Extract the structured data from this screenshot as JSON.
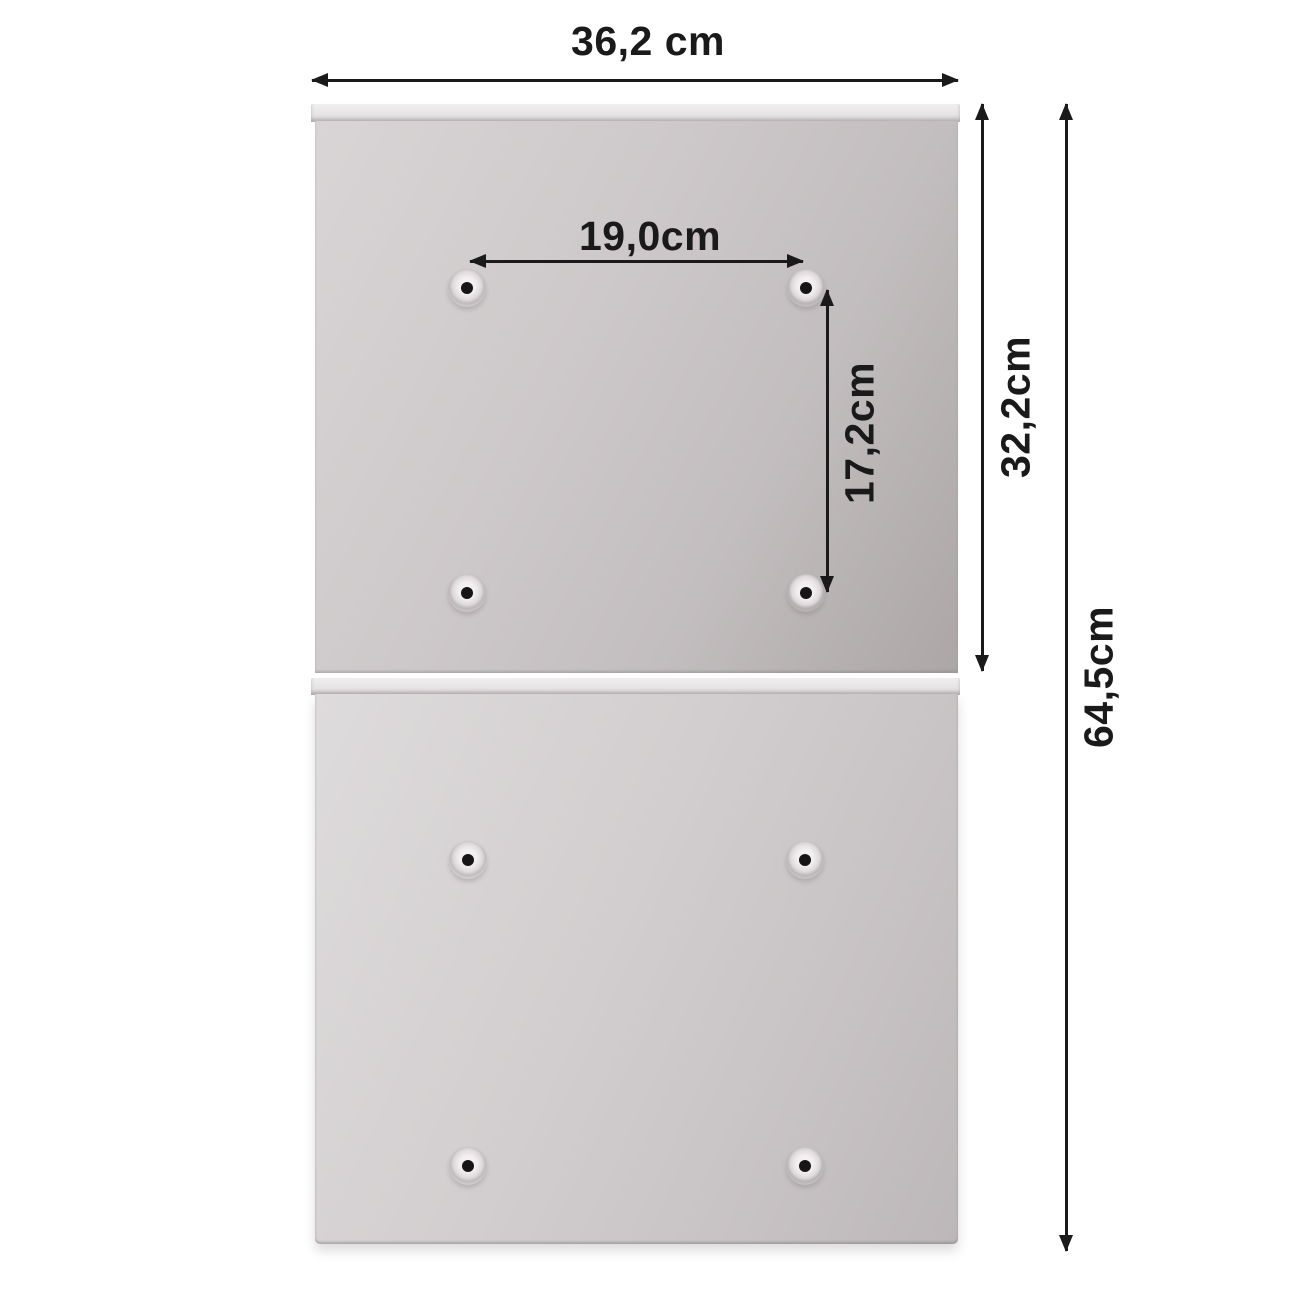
{
  "diagram": {
    "title": "cabinet back-panel dimension diagram",
    "background_color": "#ffffff",
    "annotation_color": "#1a1a1a",
    "panel_color_light": "#d9d5d6",
    "panel_color_dark": "#aca7a6",
    "panel_count": 2,
    "screw_holes_per_panel": 4,
    "dimensions": {
      "overall_width": {
        "label": "36,2 cm"
      },
      "hole_spacing_horizontal": {
        "label": "19,0cm"
      },
      "hole_spacing_vertical": {
        "label": "17,2cm"
      },
      "top_panel_height": {
        "label": "32,2cm"
      },
      "overall_height": {
        "label": "64,5cm"
      }
    }
  }
}
